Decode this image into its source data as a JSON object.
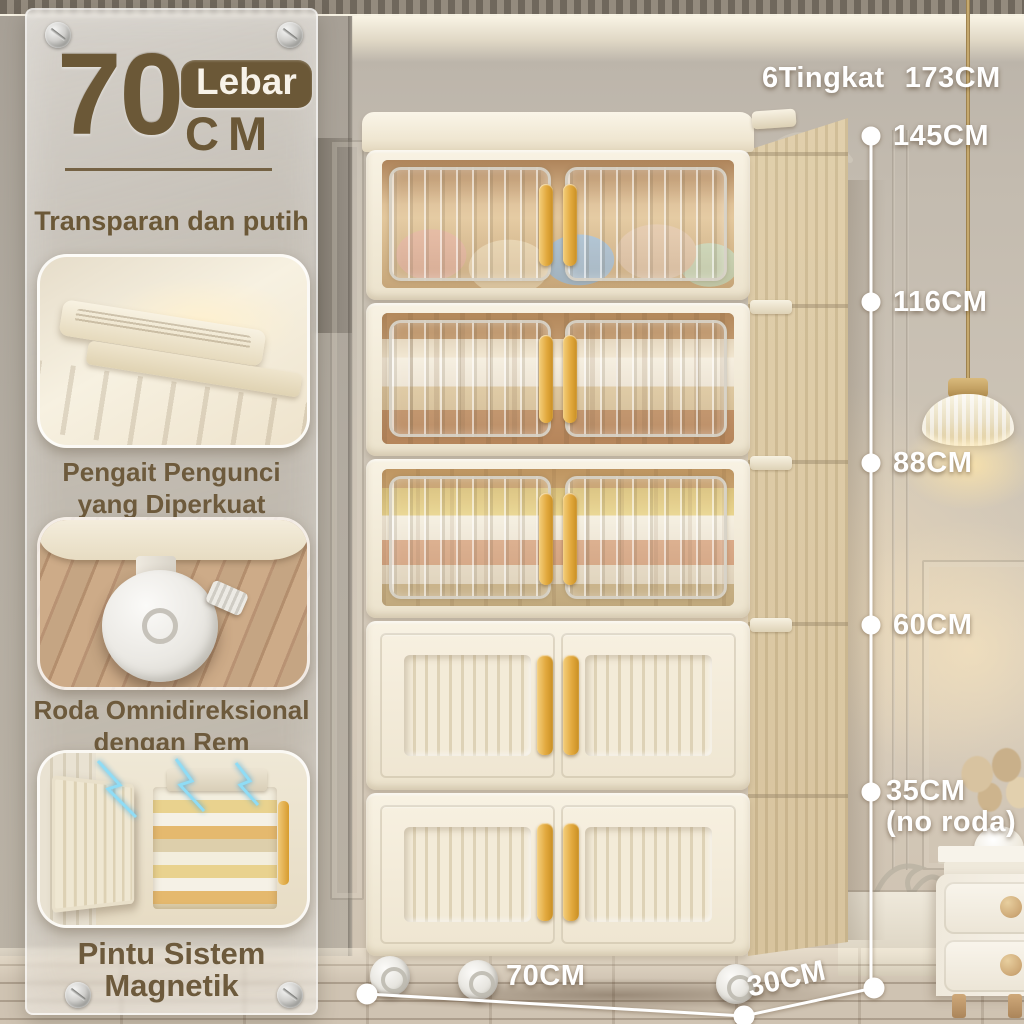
{
  "panel": {
    "width_value": "70",
    "width_badge": "Lebar",
    "width_unit": "CM",
    "subtitle": "Transparan dan putih",
    "features": [
      {
        "line1": "Pengait Pengunci",
        "line2": "yang Diperkuat"
      },
      {
        "line1": "Roda Omnidireksional",
        "line2": "dengan Rem"
      },
      {
        "line1": "Pintu Sistem Magnetik"
      }
    ]
  },
  "measurements": {
    "total_label": "6Tingkat",
    "total_value": "173CM",
    "marks": [
      "145CM",
      "116CM",
      "88CM",
      "60CM",
      "35CM"
    ],
    "mark_note": "(no roda)",
    "width_label": "70CM",
    "depth_label": "30CM"
  },
  "icons": {
    "screws": "screw-icon",
    "caster": "caster-wheel-icon",
    "lamp": "pendant-lamp"
  },
  "colors": {
    "accent_brown": "#6b5837",
    "handle_gold": "#e2a93e",
    "cabinet_cream": "#f4edda",
    "measure_white": "#ffffff"
  }
}
